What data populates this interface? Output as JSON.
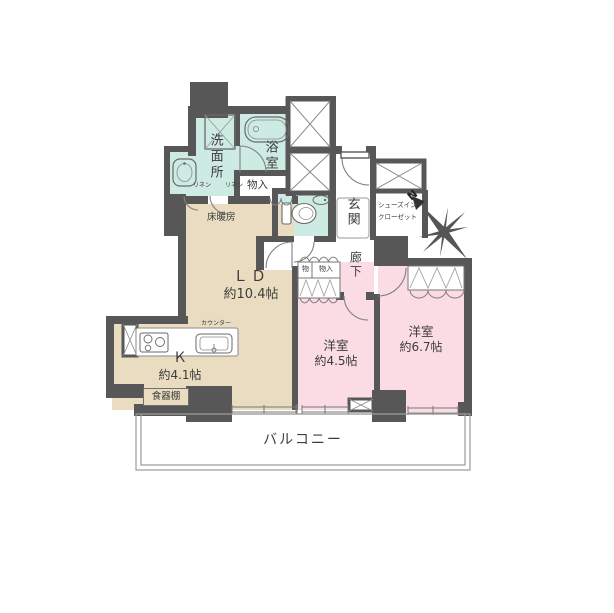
{
  "meta": {
    "type": "floor-plan",
    "style": "japanese-madori"
  },
  "colors": {
    "wall": "#575757",
    "wet_area": "#cdeae3",
    "living_area": "#e9dcc1",
    "bedroom_area": "#fbdce4",
    "thin_line": "#8a8a8a"
  },
  "rooms": {
    "washroom": {
      "label": "洗面所"
    },
    "bath": {
      "label": "浴室"
    },
    "bath_storage": {
      "label": "物入"
    },
    "linen_left": {
      "label": "リネン"
    },
    "linen_right": {
      "label": "リネン"
    },
    "entrance": {
      "label": "玄関"
    },
    "shoe_closet": {
      "line1": "シューズイン",
      "line2": "クローゼット"
    },
    "hallway": {
      "label": "廊下"
    },
    "living_dining": {
      "label": "ＬＤ",
      "size": "約10.4帖",
      "floor_heating": "床暖房"
    },
    "kitchen": {
      "label": "Ｋ",
      "size": "約4.1帖",
      "counter": "カウンター",
      "cupboard": "食器棚"
    },
    "hall_storage_small": {
      "label": "物"
    },
    "hall_storage_large": {
      "label": "物入"
    },
    "bedroom_small": {
      "label": "洋室",
      "size": "約4.5帖"
    },
    "bedroom_large": {
      "label": "洋室",
      "size": "約6.7帖"
    },
    "balcony": {
      "label": "バルコニー"
    }
  },
  "compass": {
    "label": "N"
  }
}
